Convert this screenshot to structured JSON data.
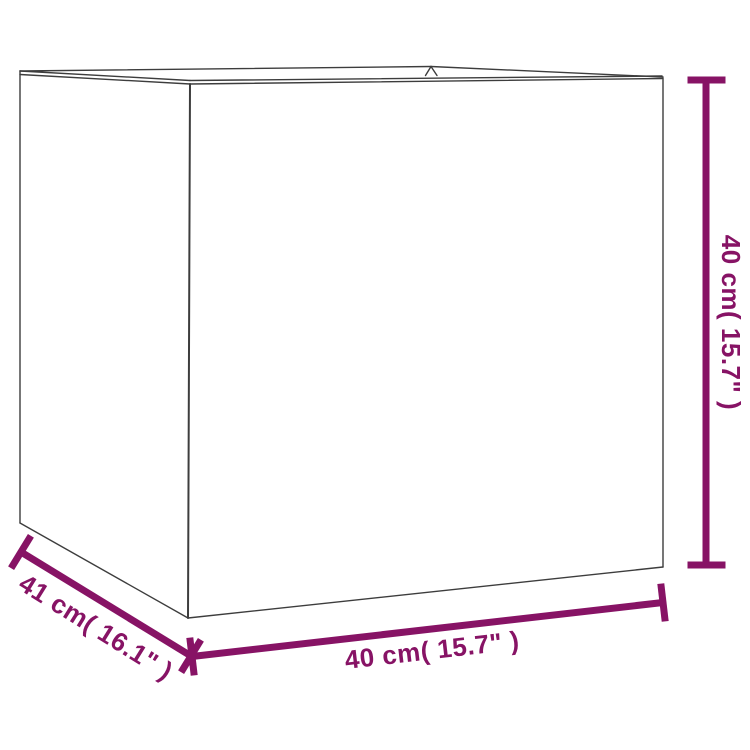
{
  "diagram": {
    "subject": "square-planter-wireframe",
    "labels": {
      "height": "40 cm( 15.7\" )",
      "width": "40 cm( 15.7\" )",
      "depth": "41 cm( 16.1\" )"
    },
    "colors": {
      "dimension_accent": "#871365",
      "outline": "#3d3d3d",
      "background": "#ffffff"
    }
  }
}
